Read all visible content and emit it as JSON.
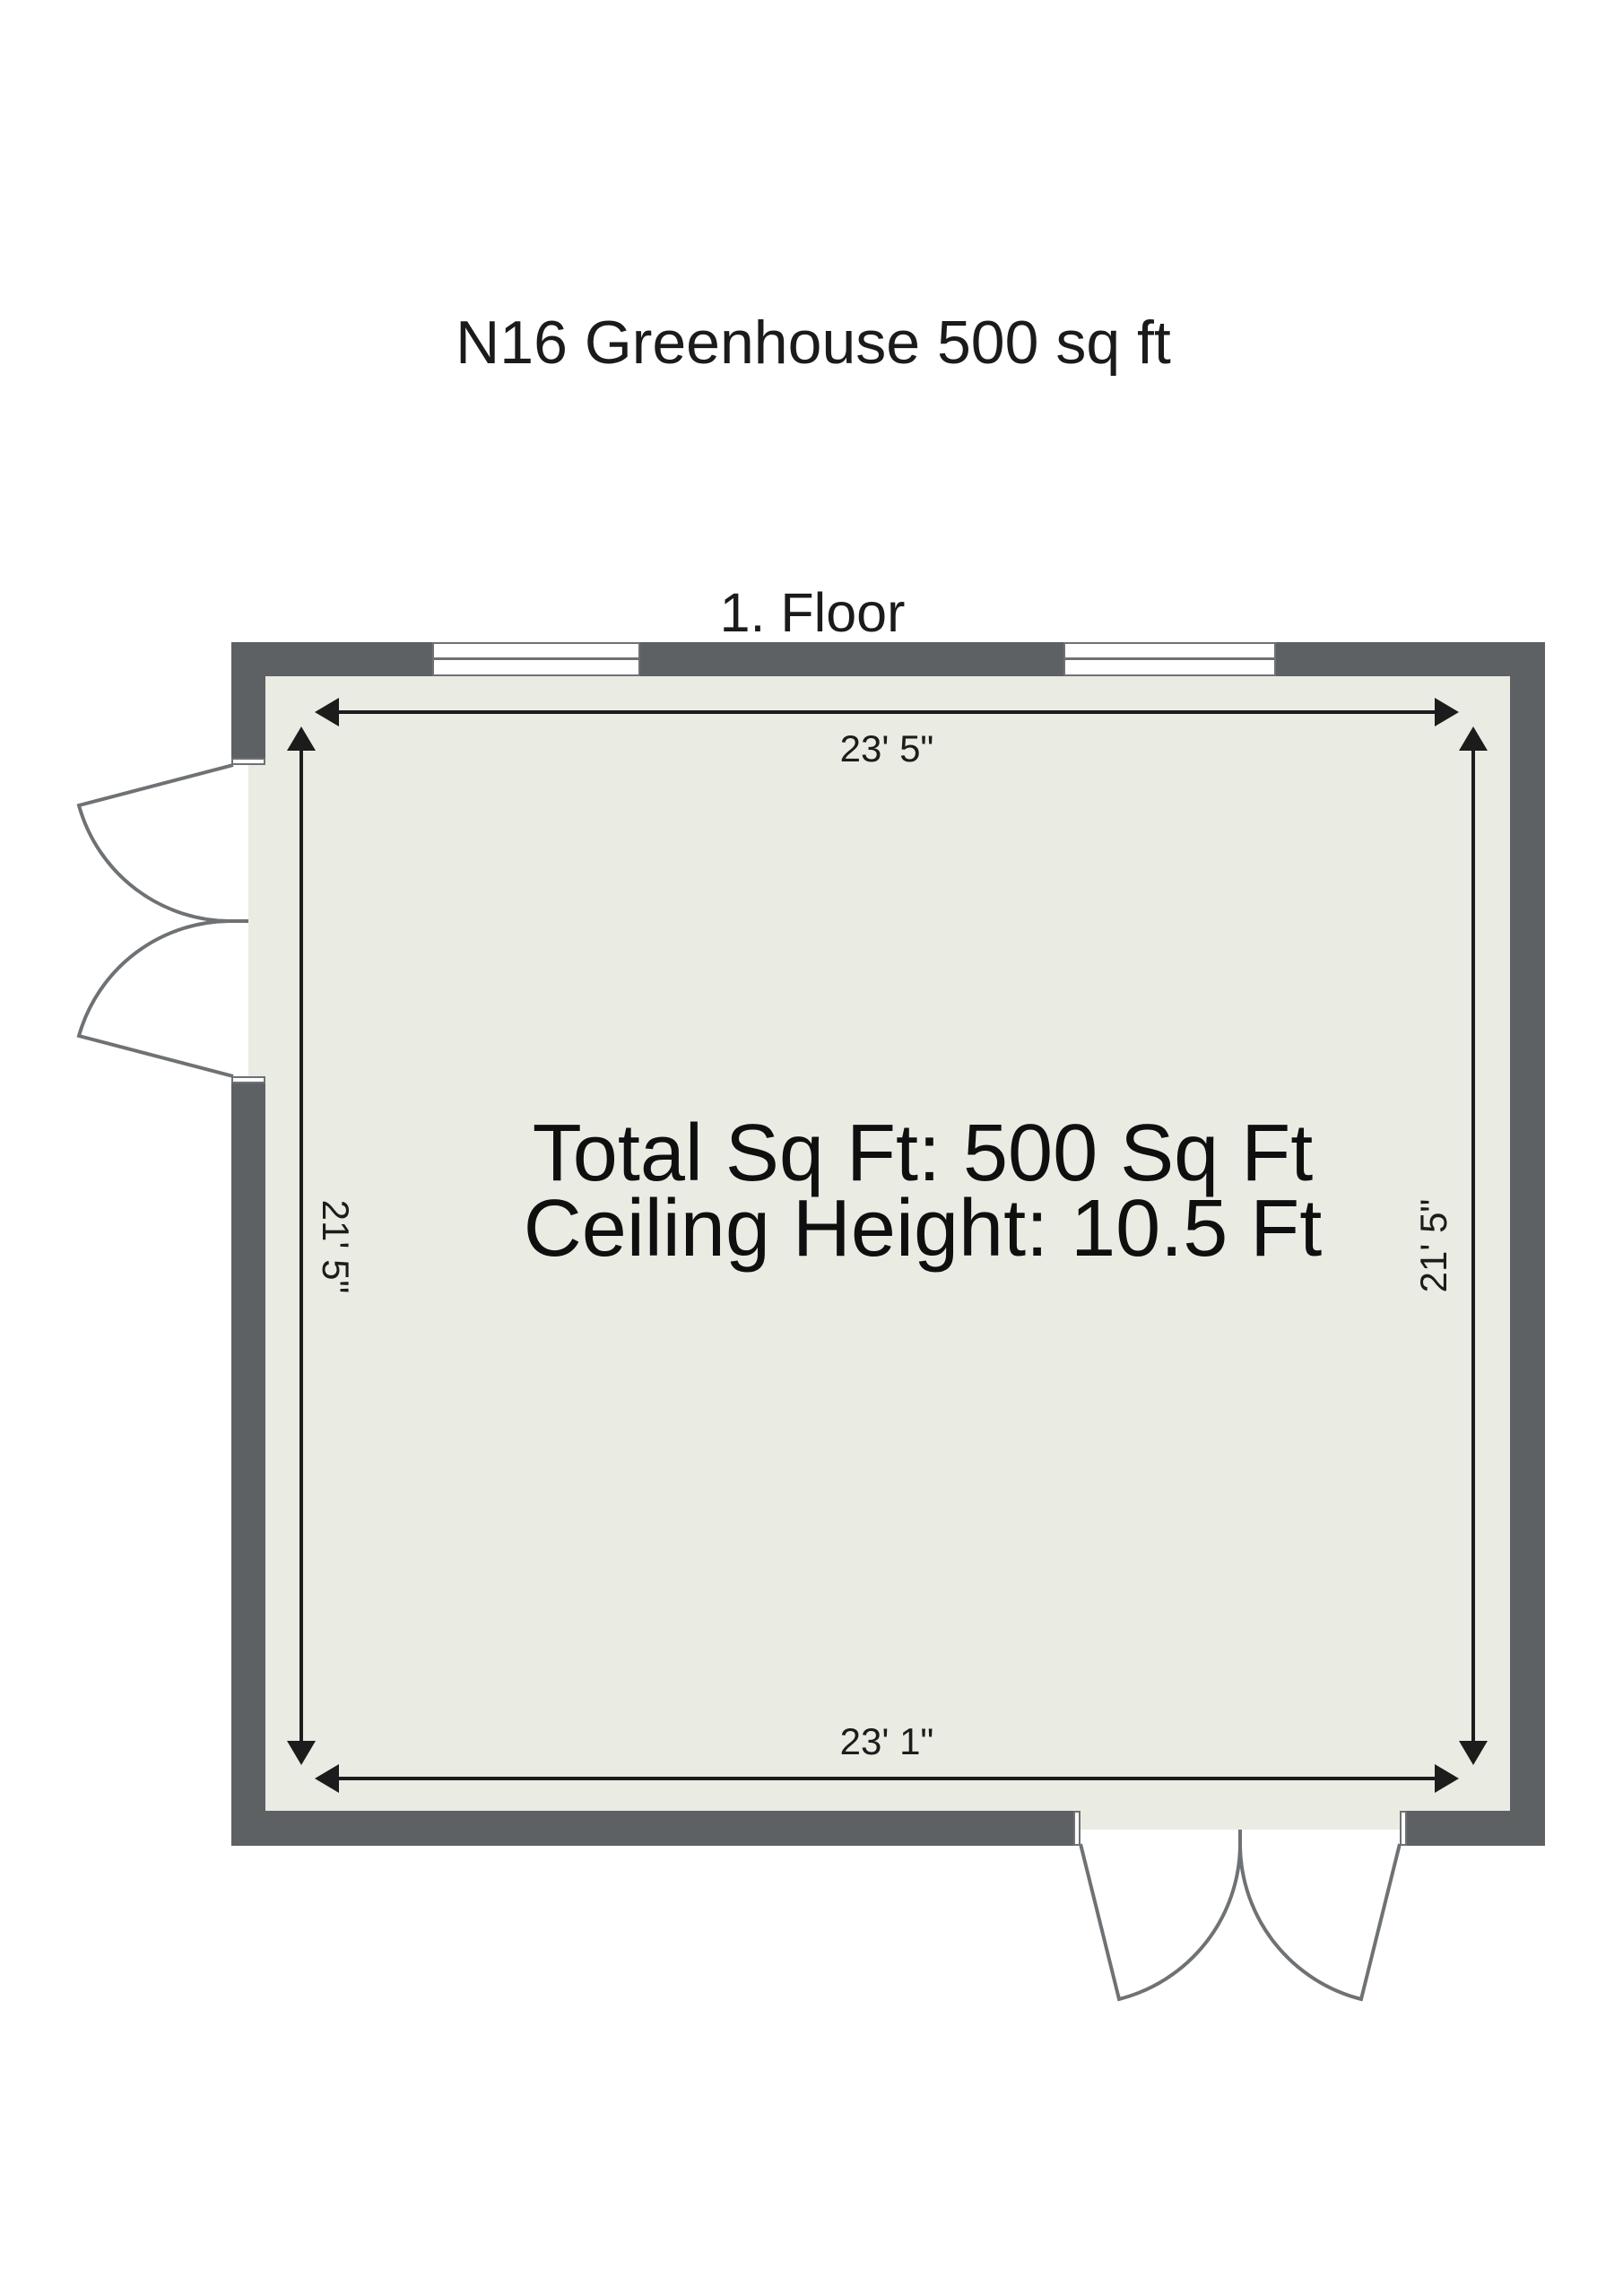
{
  "title": "N16 Greenhouse 500 sq ft",
  "floor_label": "1. Floor",
  "room": {
    "info_line1": "Total Sq Ft: 500 Sq Ft",
    "info_line2": "Ceiling Height: 10.5 Ft",
    "dim_top": "23' 5\"",
    "dim_bottom": "23' 1\"",
    "dim_left": "21' 5\"",
    "dim_right": "21' 5\""
  },
  "colors": {
    "wall": "#5d6164",
    "floor": "#eaebe3",
    "door_window_line": "#6e7275",
    "dimension_line": "#1c1c1c",
    "text": "#111111",
    "background": "#ffffff"
  }
}
